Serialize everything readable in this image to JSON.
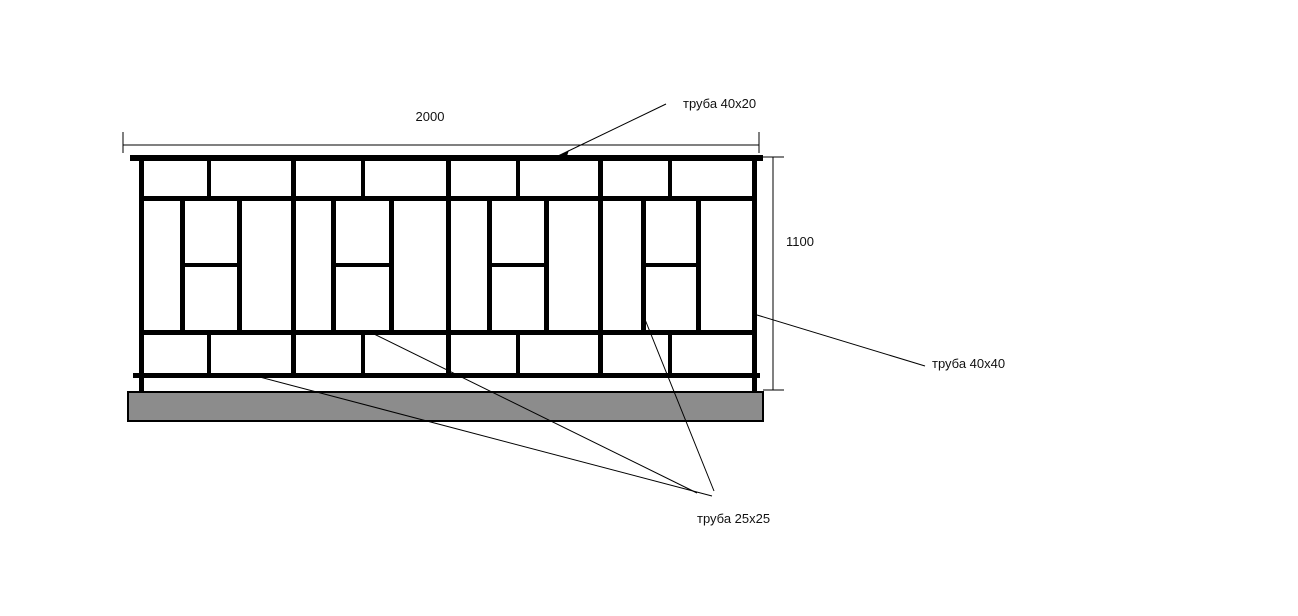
{
  "drawing": {
    "dimensions": {
      "width": "2000",
      "height": "1100"
    },
    "callouts": {
      "top_rail": "труба 40x20",
      "frame": "труба 40x40",
      "infill": "труба 25x25"
    },
    "colors": {
      "line": "#000000",
      "text": "#111111",
      "base_fill": "#8c8c8c",
      "background": "#ffffff"
    }
  }
}
